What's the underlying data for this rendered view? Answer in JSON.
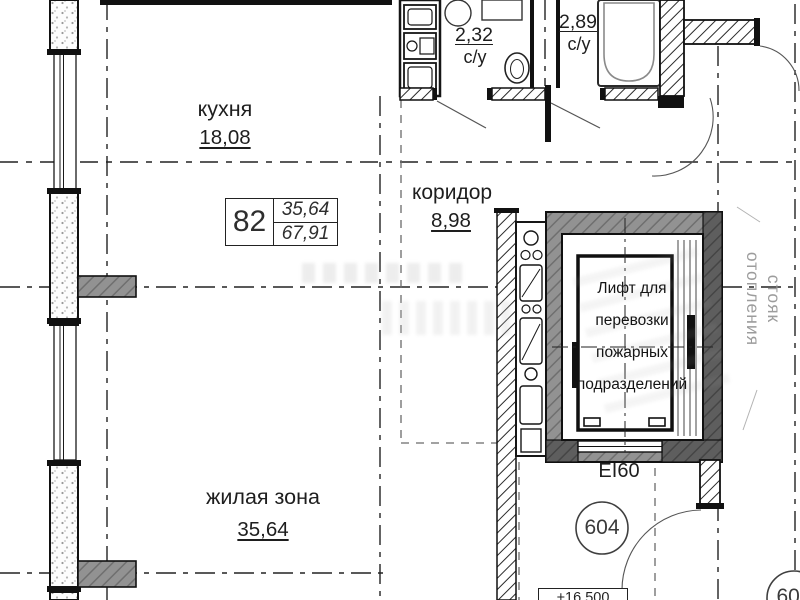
{
  "rooms": {
    "kitchen": {
      "name": "кухня",
      "area": "18,08"
    },
    "corridor": {
      "name": "коридор",
      "area": "8,98"
    },
    "living": {
      "name": "жилая зона",
      "area": "35,64"
    },
    "bathroom_small": {
      "name": "с/у",
      "area": "2,32"
    },
    "bathroom_large": {
      "name": "с/у",
      "area": "2,89"
    }
  },
  "apartment_tag": {
    "number": "82",
    "area_living": "35,64",
    "area_total": "67,91"
  },
  "elevator": {
    "line1": "Лифт для",
    "line2": "перевозки",
    "line3": "пожарных",
    "line4": "подразделений",
    "fire_rating": "EI60"
  },
  "units": {
    "room604": "604",
    "room606": "606"
  },
  "elevation_mark": "+16,500",
  "heating_riser": {
    "line1": "стояк",
    "line2": "отопления"
  },
  "colors": {
    "shaft_wall_gray": "#929292",
    "shaft_wall_dark": "#5e5e5e",
    "line_black": "#1a1a1a",
    "guide_gray": "#6a6a6a",
    "riser_label_gray": "#9c9c9c"
  }
}
